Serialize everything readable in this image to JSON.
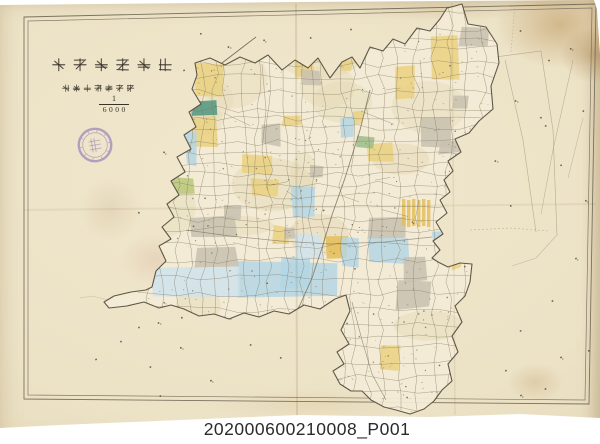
{
  "artifact": {
    "kind": "scanned historical cadastral map sheet",
    "paper_color": "#ece2c6"
  },
  "title_block": {
    "map_title_chars": "圖地庄仔庄新",
    "map_title_reading_rtl": "新庄仔庄地圖",
    "jurisdiction_chars": "里下西港廳緱阿",
    "jurisdiction_reading_rtl": "阿緱廳港西下里",
    "scale_numerator": "1",
    "scale_denominator": "6000"
  },
  "seal": {
    "description": "circular purple ink stamp, double ring, illegible small characters",
    "color": "#8166b5"
  },
  "footer": {
    "watermark_id": "202000600210008_P001"
  },
  "palette": {
    "paper": "#ece2c6",
    "parcel_base": "#f3ecd6",
    "ink": "#4b4536",
    "boundary": "#565040",
    "parcel_line": "#857b63",
    "frame_line": "#6f6755",
    "yellow": "#ead180",
    "yellow_deep": "#e4bd55",
    "blue": "#b4d6e4",
    "blue_light": "#cfe3ec",
    "green_dark": "#4f9680",
    "green_yellow": "#bac878",
    "green_soft": "#9cbc88",
    "gray": "#c8c1af",
    "faint_pencil": "#a89d82",
    "seal_purple": "#8166b5",
    "watermark_ink": "#2b2b2b"
  }
}
